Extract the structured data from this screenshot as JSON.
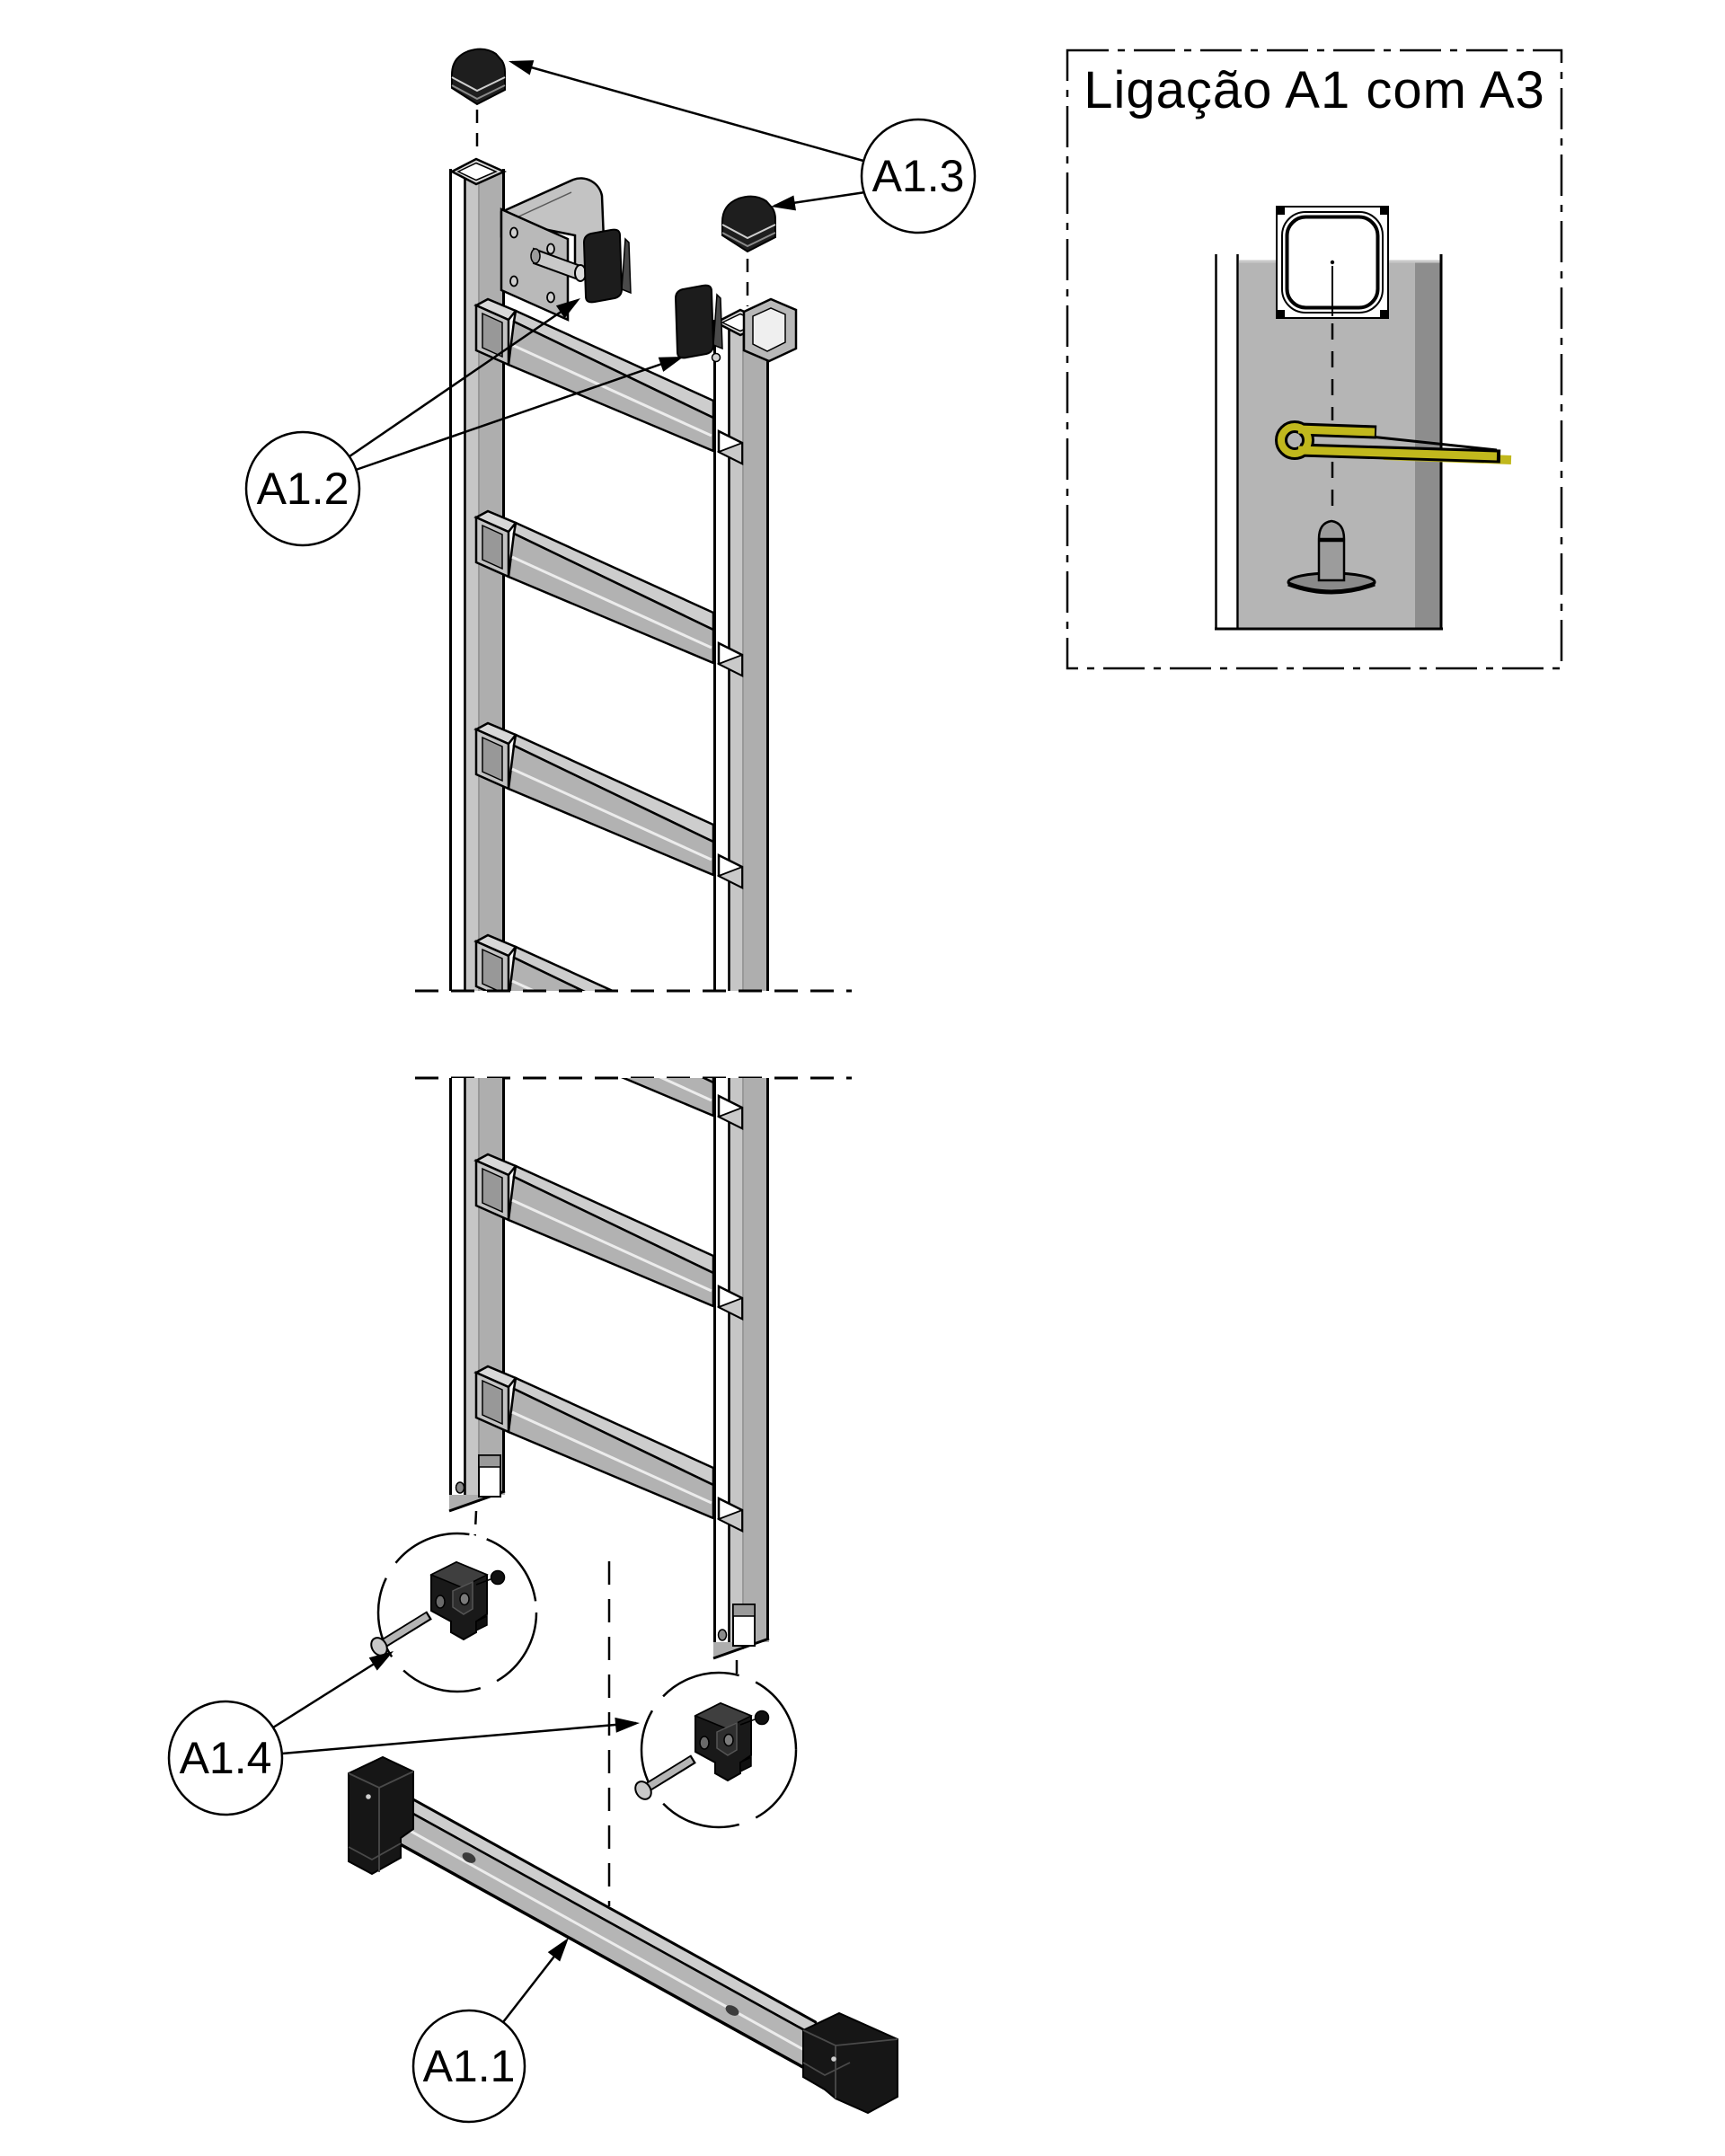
{
  "detail_box": {
    "title": "Ligação A1 com A3"
  },
  "callouts": {
    "a13": {
      "label": "A1.3"
    },
    "a12": {
      "label": "A1.2"
    },
    "a14": {
      "label": "A1.4"
    },
    "a11": {
      "label": "A1.1"
    }
  },
  "colors": {
    "background": "#ffffff",
    "outline": "#000000",
    "rail_gray": "#aeaeae",
    "rail_light": "#c6c6c6",
    "rail_dark_edge": "#8d8d8d",
    "rung_top": "#cdcdcd",
    "rung_face": "#b2b2b2",
    "cap_black": "#1a1a1a",
    "cotter_pin_yellow": "#c1b81d",
    "rivet_gray": "#9c9c9c"
  }
}
